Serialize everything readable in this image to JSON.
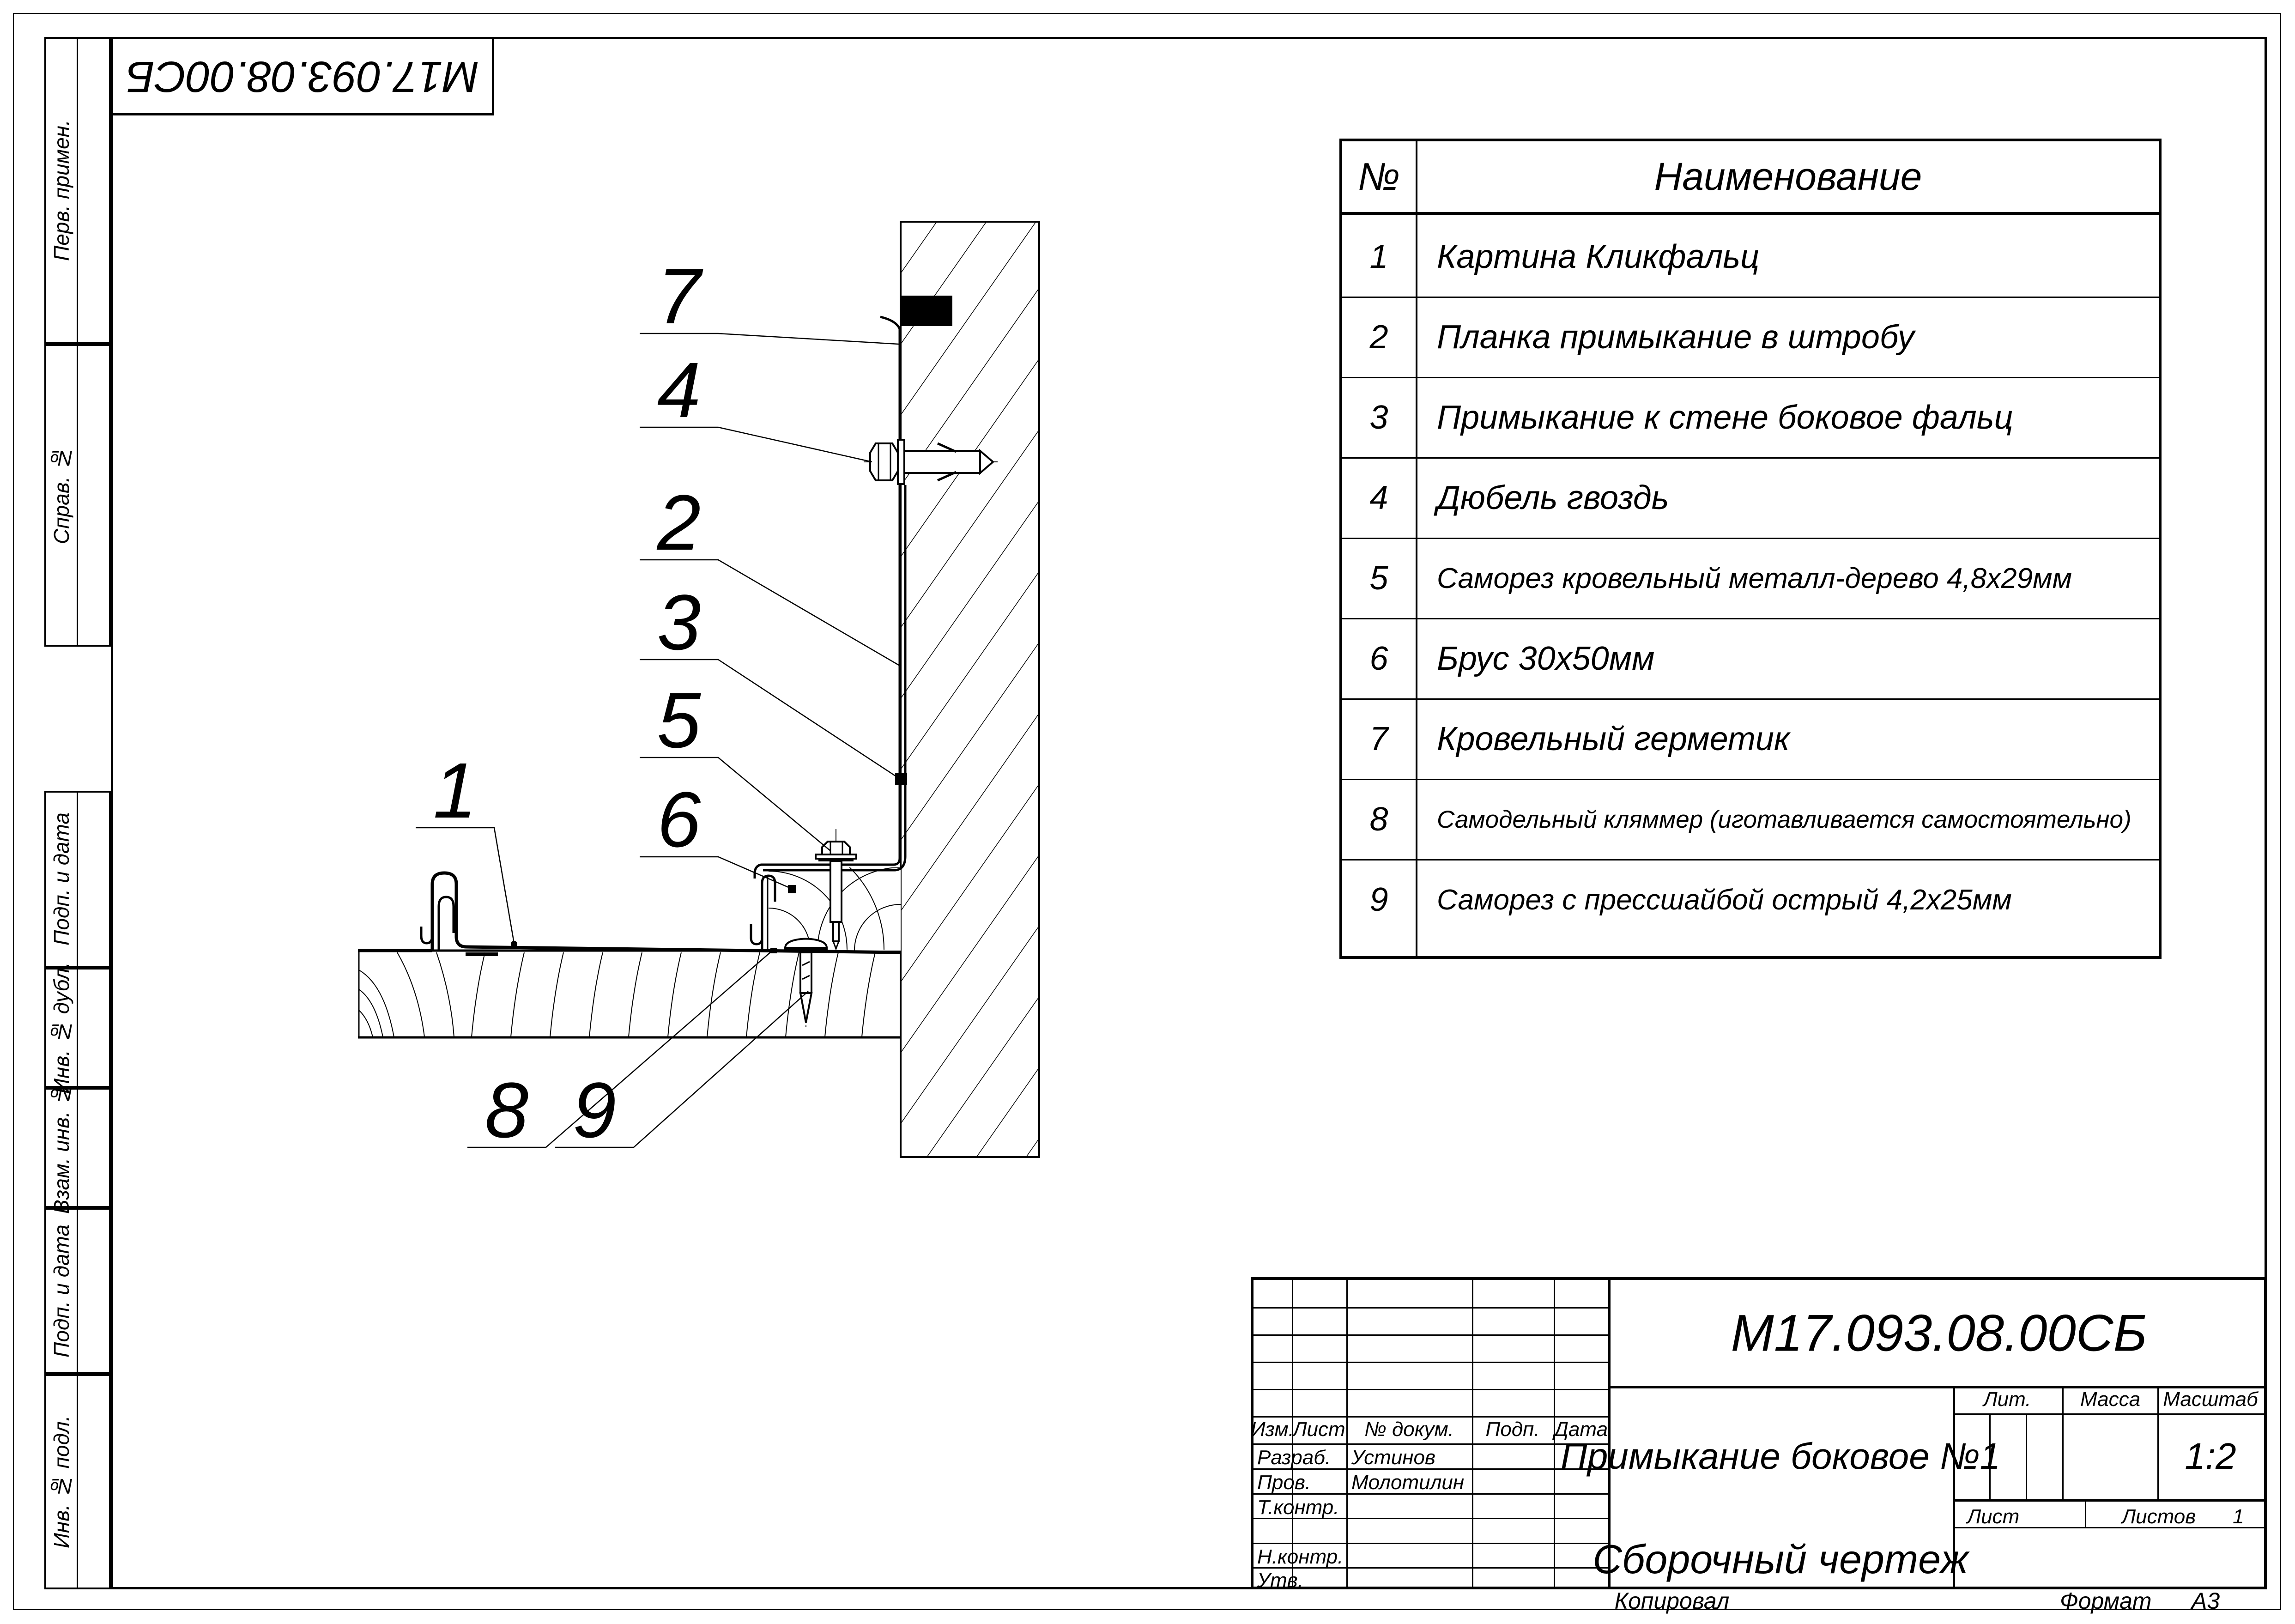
{
  "stamp_top": "М17.093.08.00СБ",
  "margin": {
    "labels": [
      "Перв. примен.",
      "Справ. №",
      "Подп. и дата",
      "Инв. № дубл.",
      "Взам. инв. №",
      "Подп. и дата",
      "Инв. № подл."
    ]
  },
  "parts_table": {
    "col_num": "№",
    "col_name": "Наименование",
    "rows": [
      {
        "num": "1",
        "name": "Картина Кликфальц"
      },
      {
        "num": "2",
        "name": "Планка примыкание в штробу"
      },
      {
        "num": "3",
        "name": "Примыкание к стене боковое фальц"
      },
      {
        "num": "4",
        "name": "Дюбель гвоздь"
      },
      {
        "num": "5",
        "name": "Саморез кровельный металл-дерево 4,8х29мм"
      },
      {
        "num": "6",
        "name": "Брус 30х50мм"
      },
      {
        "num": "7",
        "name": "Кровельный герметик"
      },
      {
        "num": "8",
        "name": "Самодельный кляммер (иготавливается самостоятельно)"
      },
      {
        "num": "9",
        "name": "Саморез с прессшайбой острый 4,2х25мм"
      }
    ]
  },
  "callouts": {
    "nums": [
      "1",
      "2",
      "3",
      "4",
      "5",
      "6",
      "7",
      "8",
      "9"
    ]
  },
  "title_block": {
    "doc_number": "М17.093.08.00СБ",
    "title": "Примыкание боковое №1",
    "doc_type": "Сборочный чертеж",
    "scale_value": "1:2",
    "sheets_value": "1",
    "razrab_value": "Устинов",
    "prov_value": "Молотилин",
    "labels": {
      "izm": "Изм.",
      "list": "Лист",
      "dokum": "№ докум.",
      "podp": "Подп.",
      "data": "Дата",
      "razrab": "Разраб.",
      "prov": "Пров.",
      "tkontr": "Т.контр.",
      "nkontr": "Н.контр.",
      "utv": "Утв.",
      "lit": "Лит.",
      "massa": "Масса",
      "masshtab": "Масштаб",
      "list2": "Лист",
      "listov": "Листов"
    }
  },
  "footer": {
    "kopiroval": "Копировал",
    "format_label": "Формат",
    "format_value": "А3"
  }
}
